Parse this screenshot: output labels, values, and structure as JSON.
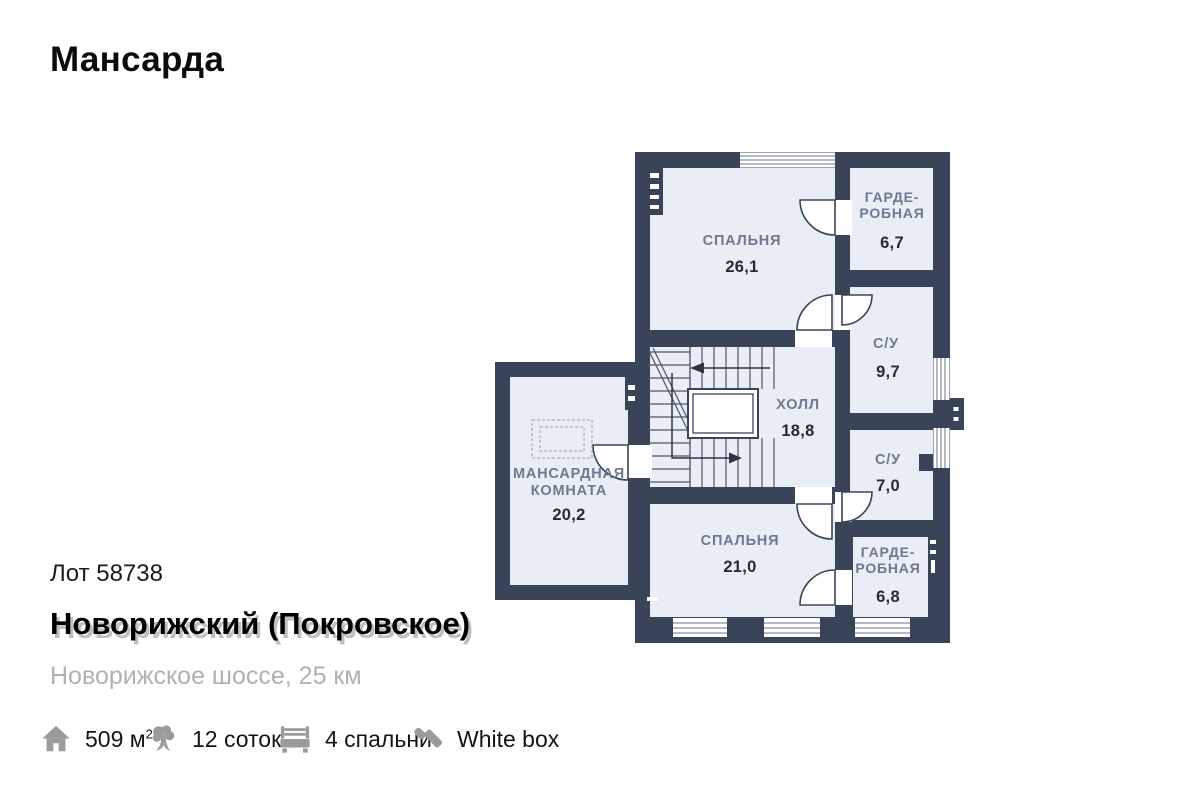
{
  "page": {
    "title": "Мансарда"
  },
  "plan": {
    "colors": {
      "wall": "#3A4458",
      "room": "#E9EDF5",
      "label": "#6E7990",
      "value": "#272B33"
    },
    "rooms": [
      {
        "id": "bedroom-upper",
        "name1": "СПАЛЬНЯ",
        "area": "26,1"
      },
      {
        "id": "wardrobe-upper",
        "name1": "ГАРДЕ-",
        "name2": "РОБНАЯ",
        "area": "6,7"
      },
      {
        "id": "bathroom-upper",
        "name1": "С/У",
        "area": "9,7"
      },
      {
        "id": "hall",
        "name1": "ХОЛЛ",
        "area": "18,8"
      },
      {
        "id": "bathroom-lower",
        "name1": "С/У",
        "area": "7,0"
      },
      {
        "id": "bedroom-lower",
        "name1": "СПАЛЬНЯ",
        "area": "21,0"
      },
      {
        "id": "wardrobe-lower",
        "name1": "ГАРДЕ-",
        "name2": "РОБНАЯ",
        "area": "6,8"
      },
      {
        "id": "attic-room",
        "name1": "МАНСАРДНАЯ",
        "name2": "КОМНАТА",
        "area": "20,2"
      }
    ]
  },
  "listing": {
    "lot": "Лот 58738",
    "title": "Новорижский (Покровское)",
    "subtitle": "Новорижское шоссе, 25 км"
  },
  "stats": [
    {
      "icon": "house-icon",
      "value": "509 м",
      "sup": "2"
    },
    {
      "icon": "tree-icon",
      "value": "12 соток"
    },
    {
      "icon": "bed-icon",
      "value": "4 спальни"
    },
    {
      "icon": "roller-icon",
      "value": "White box"
    }
  ]
}
